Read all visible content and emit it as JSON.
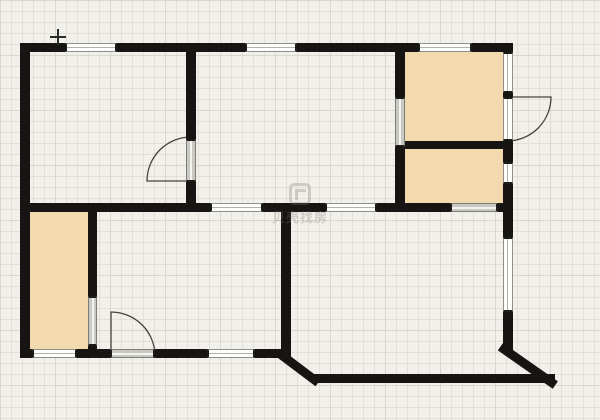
{
  "watermark": {
    "text": "贝壳找房"
  },
  "cursor": {
    "x": 58,
    "y": 37
  },
  "colors": {
    "canvas": "#f1f0ea",
    "grid": "#e2e1d8",
    "wall": "#161514",
    "room_fill": "#f3d9ae",
    "window_fill": "#fdfdfc",
    "threshold_fill": "#c9c8c3",
    "door_line": "#4a4339"
  },
  "floorplan": {
    "walls": [
      {
        "x": 20,
        "y": 43,
        "w": 493,
        "h": 9
      },
      {
        "x": 20,
        "y": 43,
        "w": 10,
        "h": 315
      },
      {
        "x": 20,
        "y": 349,
        "w": 267,
        "h": 9
      },
      {
        "x": 312,
        "y": 374,
        "w": 243,
        "h": 9
      },
      {
        "x": 503,
        "y": 43,
        "w": 10,
        "h": 309
      },
      {
        "x": 395,
        "y": 141,
        "w": 118,
        "h": 8
      },
      {
        "x": 395,
        "y": 43,
        "w": 10,
        "h": 169
      },
      {
        "x": 20,
        "y": 203,
        "w": 492,
        "h": 9
      },
      {
        "x": 186,
        "y": 52,
        "w": 10,
        "h": 160
      },
      {
        "x": 281,
        "y": 203,
        "w": 10,
        "h": 155
      },
      {
        "x": 88,
        "y": 212,
        "w": 9,
        "h": 140
      }
    ],
    "diagonal_walls": [
      {
        "x": 281,
        "y": 349,
        "len": 50,
        "angle": 37
      },
      {
        "x": 503,
        "y": 343,
        "len": 67,
        "angle": 35
      }
    ],
    "windows": [
      {
        "x": 65,
        "y": 43,
        "w": 52,
        "h": 9
      },
      {
        "x": 245,
        "y": 43,
        "w": 52,
        "h": 9
      },
      {
        "x": 418,
        "y": 43,
        "w": 54,
        "h": 9
      },
      {
        "x": 32,
        "y": 349,
        "w": 45,
        "h": 9
      },
      {
        "x": 207,
        "y": 349,
        "w": 48,
        "h": 9
      },
      {
        "x": 210,
        "y": 203,
        "w": 53,
        "h": 9
      },
      {
        "x": 325,
        "y": 203,
        "w": 52,
        "h": 9
      },
      {
        "x": 503,
        "y": 52,
        "w": 10,
        "h": 41
      },
      {
        "x": 503,
        "y": 97,
        "w": 10,
        "h": 44
      },
      {
        "x": 503,
        "y": 162,
        "w": 10,
        "h": 22
      },
      {
        "x": 503,
        "y": 237,
        "w": 10,
        "h": 75
      }
    ],
    "thresholds": [
      {
        "x": 110,
        "y": 349,
        "w": 45,
        "h": 9
      },
      {
        "x": 450,
        "y": 203,
        "w": 48,
        "h": 9
      },
      {
        "x": 88,
        "y": 296,
        "w": 9,
        "h": 50
      },
      {
        "x": 186,
        "y": 139,
        "w": 10,
        "h": 43
      },
      {
        "x": 395,
        "y": 97,
        "w": 10,
        "h": 50
      }
    ],
    "rooms": [
      {
        "x": 405,
        "y": 52,
        "w": 98,
        "h": 89
      },
      {
        "x": 405,
        "y": 149,
        "w": 98,
        "h": 54
      },
      {
        "x": 30,
        "y": 210,
        "w": 58,
        "h": 139
      }
    ],
    "doors": [
      {
        "leaf": [
          [
            191,
            181
          ],
          [
            147,
            181
          ]
        ],
        "end": [
          191,
          137
        ],
        "r": 44
      },
      {
        "leaf": [
          [
            403,
            98
          ],
          [
            447,
            98
          ]
        ],
        "end": [
          403,
          142
        ],
        "r": 44
      },
      {
        "leaf": [
          [
            507,
            97
          ],
          [
            551,
            97
          ]
        ],
        "end": [
          507,
          141
        ],
        "r": 44
      },
      {
        "leaf": [
          [
            453,
            207
          ],
          [
            453,
            163
          ]
        ],
        "end": [
          497,
          207
        ],
        "r": 44
      },
      {
        "leaf": [
          [
            111,
            356
          ],
          [
            111,
            312
          ]
        ],
        "end": [
          155,
          356
        ],
        "r": 44
      },
      {
        "leaf": [
          [
            91,
            342
          ],
          [
            47,
            342
          ]
        ],
        "end": [
          91,
          298
        ],
        "r": 44
      }
    ]
  }
}
